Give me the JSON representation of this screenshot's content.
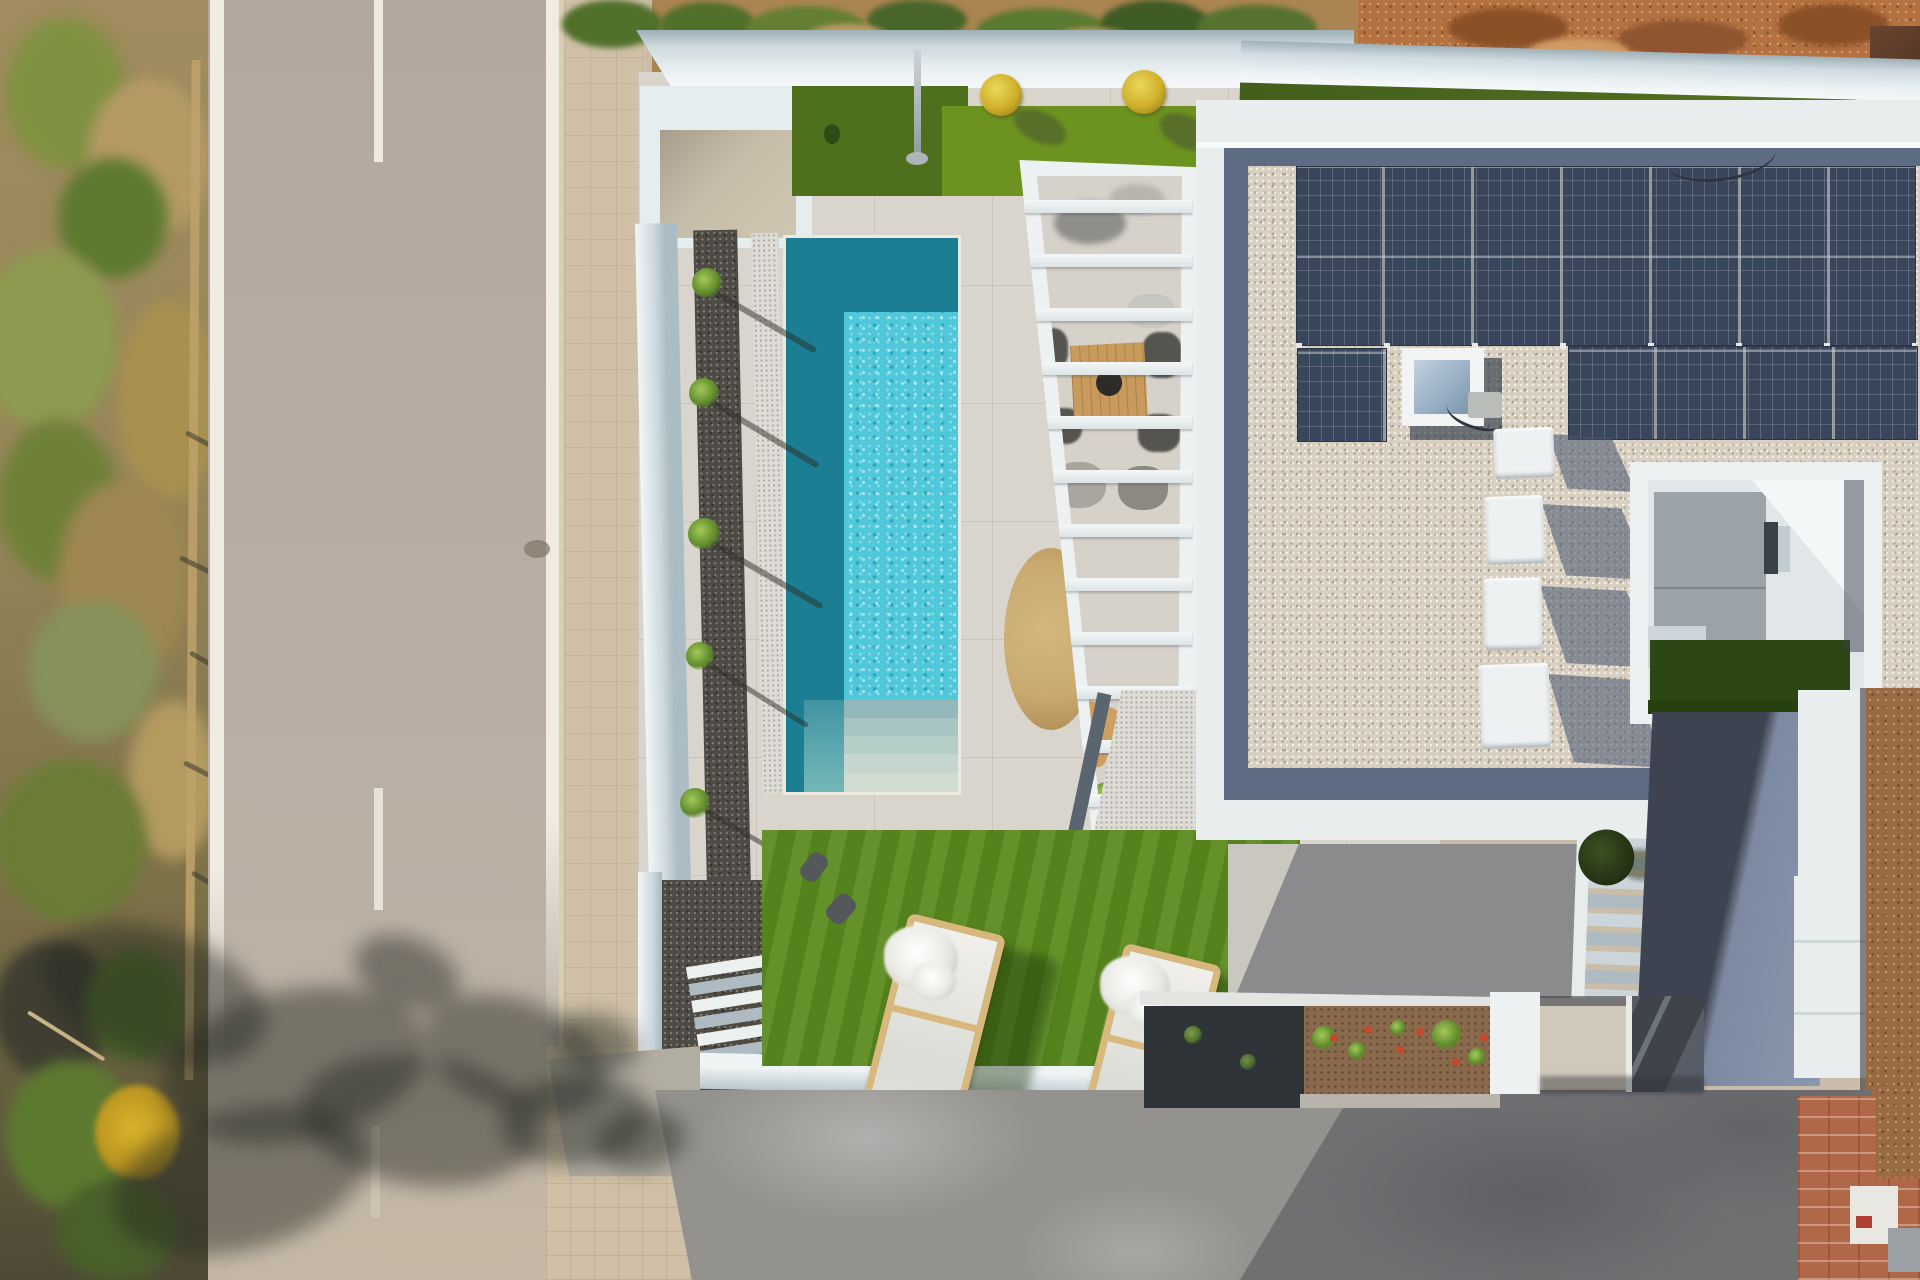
{
  "meta": {
    "type": "aerial-drone-photograph",
    "description": "Top-down aerial photo of a modern white villa: long turquoise pool with roman steps, artificial lawns, white slatted pergola over a dining patio, flat gravel roof with two rows of solar panels, a skylight and four AC units, an interior courtyard, exterior stairs, a sloped ramp, gray concrete driveway, and an asphalt road with a dry vegetated verge on the left"
  },
  "scene": {
    "regions": {
      "verge": {
        "label": "Dry roadside verge with shrubs, fence posts and tree shadows"
      },
      "road": {
        "label": "Asphalt road with white edge lines and dashed center line"
      },
      "sidewalk": {
        "label": "Beige tiled sidewalk"
      },
      "pool": {
        "label": "Rectangular swimming pool, shaded teal on one side, sparkling turquoise on the other",
        "colors": [
          "#1b7e92",
          "#4fc8da"
        ]
      },
      "pool_steps": {
        "label": "Roman entry steps at the near end of the pool"
      },
      "lawn_top": {
        "label": "Two-tone artificial grass patch by the entrance"
      },
      "lawn": {
        "label": "Artificial lawn with two wooden sun loungers and towels"
      },
      "pergola": {
        "label": "White slatted pergola over outdoor dining and lounge area"
      },
      "roof": {
        "label": "Flat roof finished in beige gravel with dark blue-gray border strip"
      },
      "solar": {
        "label": "Dark photovoltaic solar panel array, two rows",
        "rows": 2
      },
      "skylight": {
        "label": "Square roof skylight with white frame"
      },
      "ac_units": {
        "label": "Four white rooftop AC units casting blue shadows",
        "count": 4
      },
      "courtyard": {
        "label": "Interior lightwell courtyard with gray tiles, window and dark green grass"
      },
      "stairs": {
        "label": "Exterior side staircase with a dark green bush"
      },
      "ramp": {
        "label": "Sloped side ramp, half in shadow"
      },
      "driveway": {
        "label": "Mottled gray concrete driveway with building shadow"
      },
      "garden_bed": {
        "label": "Low planter and soil bed with small green plants and red flowers"
      },
      "entry": {
        "label": "Entry with dark glass door and white wall stub"
      },
      "brick": {
        "label": "Neighboring unfinished terracotta brick roof corner"
      },
      "dirt": {
        "label": "Bare orange-brown earth strip along the upper and right edges"
      }
    },
    "objects": {
      "sun_loungers": 2,
      "flower_pots": 2,
      "ac_units": 4,
      "solar_panel_rows": 2,
      "small_shrubs_along_pool": 6,
      "dining_table": 1,
      "skylight": 1
    }
  },
  "palette": {
    "road": "#b6aba1",
    "sidewalk": "#cfc0a7",
    "paving": "#d9d5cc",
    "wall-white": "#e9edee",
    "pool-dark": "#1b7e92",
    "pool-bright": "#4fc8da",
    "grass-lawn": "#5b8a1e",
    "grass-dark": "#4e701c",
    "grass-bright": "#6c921f",
    "gravel-dark": "#4e4a44",
    "gravel-white": "#dedcd6",
    "roof-gravel": "#d8cfc0",
    "roof-border-dark": "#5d6b83",
    "solar": "#3a465b",
    "skylight": "#9db3c8",
    "ac-white": "#eef1f2",
    "driveway": "#93928f",
    "ramp-dark": "#3d4350",
    "ramp-light": "#8b97ad",
    "dirt-orange": "#b5713f",
    "dirt-brown": "#9a6b42",
    "brick": "#b06848",
    "planter-dark": "#2f3438",
    "soil": "#8a6a4c",
    "wood": "#c89a5c",
    "rug": "#c9a96e",
    "lounger-wood": "#d9b87e"
  }
}
